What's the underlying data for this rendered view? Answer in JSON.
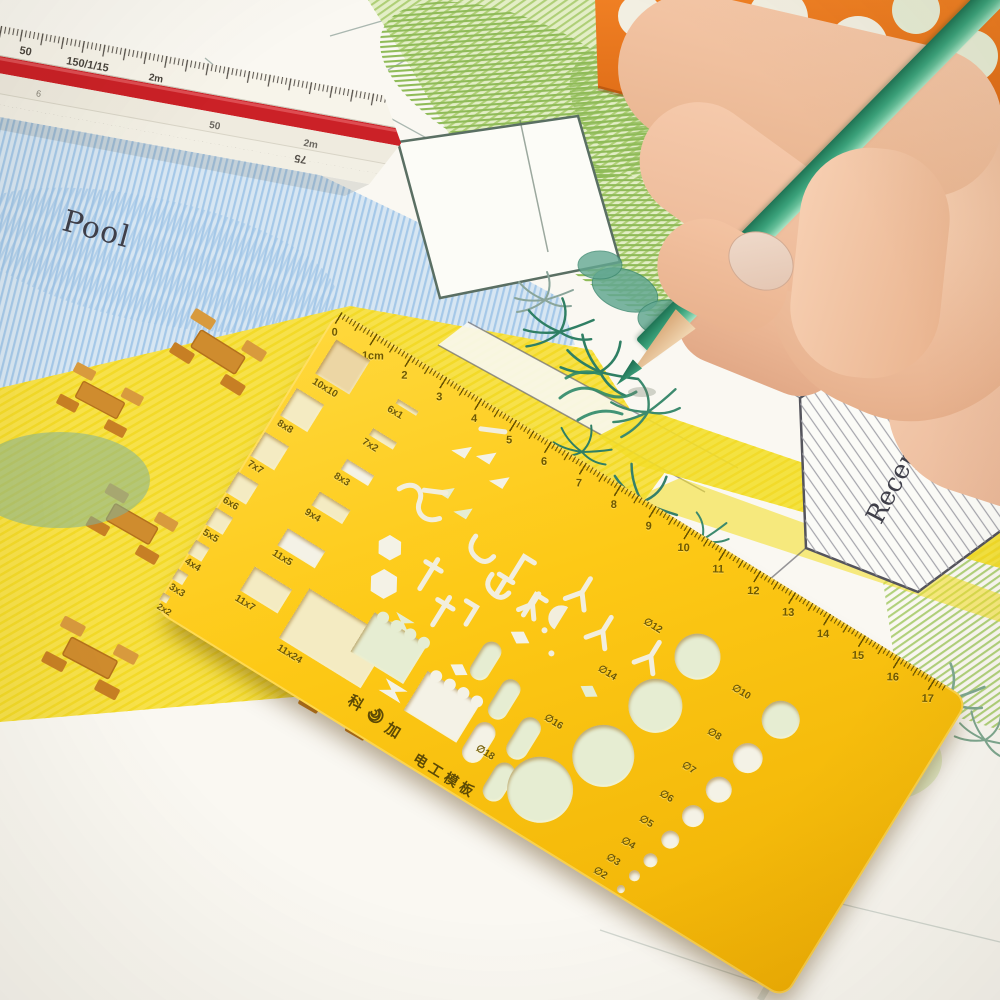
{
  "drawing": {
    "pool_label": "Pool",
    "reception_label": "Reception"
  },
  "scale_ruler": {
    "face1_marks": [
      "50",
      "150/1/15",
      "2m"
    ],
    "face2_marks": [
      "9",
      "6",
      "50",
      "2m"
    ],
    "face3_marks": [
      "75"
    ]
  },
  "template": {
    "brand_left": "科",
    "brand_right": "加",
    "product_name": "电工模板",
    "ruler_labels": [
      "0",
      "1cm",
      "2",
      "3",
      "4",
      "5",
      "6",
      "7",
      "8",
      "9",
      "10",
      "11",
      "12",
      "13",
      "14",
      "15",
      "16",
      "17"
    ],
    "square_labels": [
      "10x10",
      "8x8",
      "7x7",
      "6x6",
      "5x5",
      "4x4",
      "3x3",
      "2x2"
    ],
    "slot_labels": [
      "6x1",
      "7x2",
      "8x3",
      "9x4",
      "11x5",
      "11x7"
    ],
    "large_rect_label": "11x24",
    "circle_labels": [
      "∅12",
      "∅14",
      "∅16",
      "∅18",
      "∅10",
      "∅8",
      "∅7",
      "∅6",
      "∅5",
      "∅4",
      "∅3",
      "∅2"
    ]
  },
  "colors": {
    "template_yellow": "#fcc916",
    "template_text": "#6d5806",
    "orange_template": "#e4701c",
    "pencil_green": "#3ba27b",
    "scale_ruler_stripe_red": "#cb2127",
    "pool_blue": "#d7e6f2",
    "deck_yellow": "#f7e14a",
    "foliage_green": "#a9cc6e"
  }
}
